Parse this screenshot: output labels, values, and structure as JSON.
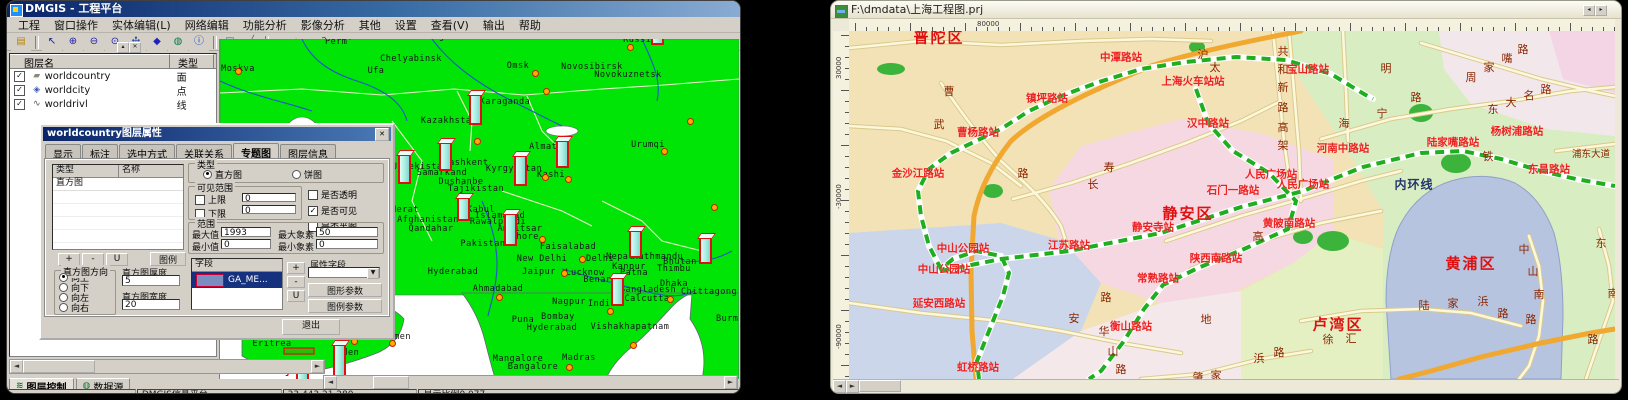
{
  "left_window": {
    "title": "DMGIS - 工程平台",
    "menu_items": [
      "工程",
      "窗口操作",
      "实体编辑(L)",
      "网络编辑",
      "功能分析",
      "影像分析",
      "其他",
      "设置",
      "查看(V)",
      "输出",
      "帮助"
    ],
    "toolbar": [
      {
        "n": "open-folder-icon",
        "g": "▤",
        "c": "#b8860b",
        "sep": false
      },
      {
        "n": "select-arrow-icon",
        "g": "↖",
        "c": "#1a1aaa",
        "sep": true
      },
      {
        "n": "zoom-in-icon",
        "g": "⊕",
        "c": "#1a1aaa",
        "sep": false
      },
      {
        "n": "zoom-out-icon",
        "g": "⊖",
        "c": "#1a1aaa",
        "sep": false
      },
      {
        "n": "zoom-free-icon",
        "g": "⊙",
        "c": "#1a1aaa",
        "sep": false
      },
      {
        "n": "pan-hand-icon",
        "g": "✣",
        "c": "#2a4a9a",
        "sep": false
      },
      {
        "n": "polygon-icon",
        "g": "◆",
        "c": "#2222bb",
        "sep": false
      },
      {
        "n": "globe-icon",
        "g": "◍",
        "c": "#0a7a4a",
        "sep": false
      },
      {
        "n": "info-icon",
        "g": "ⓘ",
        "c": "#1133bb",
        "sep": false
      },
      {
        "n": "rectangle-icon",
        "g": "▣",
        "c": "#008b8b",
        "sep": true
      },
      {
        "n": "measure-icon",
        "g": "╱",
        "c": "#666666",
        "sep": false
      },
      {
        "n": "print-icon",
        "g": "▄",
        "c": "#334466",
        "sep": true
      },
      {
        "n": "bmp-icon",
        "g": "bmp",
        "c": "#1a6a1a",
        "sep": false
      },
      {
        "n": "help-icon",
        "g": "?",
        "c": "#007700",
        "sep": false
      }
    ],
    "panel": {
      "columns": [
        "图层名",
        "类型"
      ],
      "layers": [
        {
          "name": "worldcountry",
          "type": "面",
          "icon": "▰",
          "ic": "#8a8a7a"
        },
        {
          "name": "worldcity",
          "type": "点",
          "icon": "◈",
          "ic": "#3a5aaa"
        },
        {
          "name": "worldrivl",
          "type": "线",
          "icon": "∿",
          "ic": "#555555"
        }
      ],
      "tabs": [
        {
          "label": "图层控制",
          "g": "≋"
        },
        {
          "label": "数据源",
          "g": "◍"
        }
      ]
    },
    "dialog": {
      "title": "worldcountry图层属性",
      "close_glyph": "✕",
      "tabs": [
        "显示",
        "标注",
        "选中方式",
        "关联关系",
        "专题图",
        "图层信息"
      ],
      "active_tab": "专题图",
      "list_columns": [
        "类型",
        "名称"
      ],
      "list_rows": [
        "直方图"
      ],
      "small_buttons": [
        "+",
        "-",
        "U"
      ],
      "legend_button": "图例",
      "direction_group": {
        "label": "直方图方向",
        "options": [
          "向上",
          "向下",
          "向左",
          "向右"
        ],
        "selected": "向上"
      },
      "thickness": {
        "label": "直方图厚度",
        "value": "5"
      },
      "bar_width": {
        "label": "直方图宽度",
        "value": "20"
      },
      "type_group": {
        "label": "类型",
        "options": [
          "直方图",
          "饼图"
        ],
        "selected": "直方图"
      },
      "visible_range": {
        "label": "可见范围",
        "upper": "上限",
        "upper_val": "0",
        "lower": "下限",
        "lower_val": "0"
      },
      "flags": [
        {
          "label": "是否透明",
          "checked": false
        },
        {
          "label": "是否可见",
          "checked": true
        },
        {
          "label": "是否半图",
          "checked": false
        }
      ],
      "range": {
        "label": "范围",
        "max_l": "最大值",
        "max_v": "1993",
        "maxpx_l": "最大象素",
        "maxpx_v": "50",
        "min_l": "最小值",
        "min_v": "0",
        "minpx_l": "最小象素",
        "minpx_v": "0"
      },
      "field_group": {
        "label": "字段",
        "selected": "GA_ME..."
      },
      "mini_buttons": [
        "+",
        "-",
        "U"
      ],
      "attr_label": "属性字段",
      "param_buttons": [
        "图形参数",
        "图例参数"
      ],
      "exit_button": "退出"
    },
    "status_cells": [
      "",
      "DMGIS信息平台",
      "33.443,21.280",
      "显示比例0.077"
    ],
    "map": {
      "cities": [
        {
          "t": "Perm'",
          "x": 337,
          "y": 41
        },
        {
          "t": "Yekaterinburg",
          "x": 406,
          "y": 36
        },
        {
          "t": "Chelyabinsk",
          "x": 409,
          "y": 58
        },
        {
          "t": "Ufa",
          "x": 374,
          "y": 70
        },
        {
          "t": "Moskva",
          "x": 236,
          "y": 68
        },
        {
          "t": "Omsk",
          "x": 516,
          "y": 65
        },
        {
          "t": "Novosibirsk",
          "x": 590,
          "y": 66
        },
        {
          "t": "Novokuznetsk",
          "x": 626,
          "y": 74
        },
        {
          "t": "Russia",
          "x": 638,
          "y": 39
        },
        {
          "t": "Karaganda",
          "x": 503,
          "y": 101
        },
        {
          "t": "Kazakhstan",
          "x": 447,
          "y": 120
        },
        {
          "t": "Urumqi",
          "x": 646,
          "y": 144
        },
        {
          "t": "Almaty",
          "x": 544,
          "y": 146
        },
        {
          "t": "Tashkent",
          "x": 464,
          "y": 162
        },
        {
          "t": "Samarkand",
          "x": 440,
          "y": 172
        },
        {
          "t": "Dushanbe",
          "x": 459,
          "y": 181
        },
        {
          "t": "Tajikistan",
          "x": 474,
          "y": 188
        },
        {
          "t": "Kyrgyzstan",
          "x": 512,
          "y": 168
        },
        {
          "t": "Kashi",
          "x": 549,
          "y": 174
        },
        {
          "t": "Uzbekistan",
          "x": 418,
          "y": 166
        },
        {
          "t": "Herat",
          "x": 403,
          "y": 209
        },
        {
          "t": "Afghanistan",
          "x": 426,
          "y": 219
        },
        {
          "t": "Kabul",
          "x": 479,
          "y": 209
        },
        {
          "t": "Qandahar",
          "x": 429,
          "y": 228
        },
        {
          "t": "Islamabad",
          "x": 498,
          "y": 215
        },
        {
          "t": "Rawalpindi",
          "x": 496,
          "y": 221
        },
        {
          "t": "Amritsar",
          "x": 518,
          "y": 228
        },
        {
          "t": "Lahore",
          "x": 520,
          "y": 236
        },
        {
          "t": "Pakistan",
          "x": 481,
          "y": 243
        },
        {
          "t": "Faisalabad",
          "x": 566,
          "y": 246
        },
        {
          "t": "New Delhi",
          "x": 540,
          "y": 258
        },
        {
          "t": "Delhi",
          "x": 598,
          "y": 258
        },
        {
          "t": "Jaipur",
          "x": 537,
          "y": 271
        },
        {
          "t": "Lucknow",
          "x": 583,
          "y": 272
        },
        {
          "t": "Kanpur",
          "x": 627,
          "y": 266
        },
        {
          "t": "Patna",
          "x": 632,
          "y": 272
        },
        {
          "t": "Benares",
          "x": 601,
          "y": 279
        },
        {
          "t": "Thimbu",
          "x": 672,
          "y": 268
        },
        {
          "t": "Bhutan",
          "x": 678,
          "y": 261
        },
        {
          "t": "Kathmandu",
          "x": 656,
          "y": 256
        },
        {
          "t": "Nepal",
          "x": 618,
          "y": 256
        },
        {
          "t": "Dhaka",
          "x": 672,
          "y": 283
        },
        {
          "t": "Bangladesh",
          "x": 646,
          "y": 289
        },
        {
          "t": "Chittagong",
          "x": 707,
          "y": 291
        },
        {
          "t": "Calcutta",
          "x": 645,
          "y": 298
        },
        {
          "t": "Ahmadabad",
          "x": 496,
          "y": 288
        },
        {
          "t": "Hyderabad",
          "x": 451,
          "y": 271
        },
        {
          "t": "Nagpur",
          "x": 567,
          "y": 301
        },
        {
          "t": "India",
          "x": 600,
          "y": 303
        },
        {
          "t": "Bombay",
          "x": 556,
          "y": 316
        },
        {
          "t": "Puna",
          "x": 521,
          "y": 319
        },
        {
          "t": "Hyderabad",
          "x": 550,
          "y": 327
        },
        {
          "t": "Vishakhapatnam",
          "x": 628,
          "y": 326
        },
        {
          "t": "Mangalore",
          "x": 516,
          "y": 358
        },
        {
          "t": "Madras",
          "x": 577,
          "y": 357
        },
        {
          "t": "Bangalore",
          "x": 531,
          "y": 366
        },
        {
          "t": "Burma",
          "x": 728,
          "y": 318
        },
        {
          "t": "Asmara",
          "x": 262,
          "y": 336
        },
        {
          "t": "Eritrea",
          "x": 270,
          "y": 343
        },
        {
          "t": "Sanaa",
          "x": 330,
          "y": 333
        },
        {
          "t": "Yemen",
          "x": 395,
          "y": 336
        },
        {
          "t": "Aden",
          "x": 346,
          "y": 352
        },
        {
          "t": "Djibouti",
          "x": 300,
          "y": 371,
          "cls": "red"
        }
      ],
      "bars": [
        {
          "x": 655,
          "y": 44,
          "h": 12
        },
        {
          "x": 473,
          "y": 124,
          "h": 32
        },
        {
          "x": 402,
          "y": 183,
          "h": 31
        },
        {
          "x": 443,
          "y": 170,
          "h": 30
        },
        {
          "x": 518,
          "y": 185,
          "h": 32
        },
        {
          "x": 560,
          "y": 167,
          "h": 29
        },
        {
          "x": 461,
          "y": 220,
          "h": 25
        },
        {
          "x": 508,
          "y": 245,
          "h": 34
        },
        {
          "x": 633,
          "y": 257,
          "h": 29
        },
        {
          "x": 703,
          "y": 263,
          "h": 28
        },
        {
          "x": 615,
          "y": 305,
          "h": 30
        },
        {
          "x": 337,
          "y": 378,
          "h": 36
        },
        {
          "x": 300,
          "y": 384,
          "h": 20
        }
      ],
      "dots": [
        [
          236,
          70
        ],
        [
          533,
          72
        ],
        [
          628,
          46
        ],
        [
          544,
          90
        ],
        [
          566,
          178
        ],
        [
          543,
          176
        ],
        [
          475,
          140
        ],
        [
          540,
          238
        ],
        [
          580,
          258
        ],
        [
          562,
          272
        ],
        [
          497,
          296
        ],
        [
          608,
          310
        ],
        [
          668,
          298
        ],
        [
          631,
          344
        ],
        [
          567,
          366
        ],
        [
          712,
          206
        ],
        [
          662,
          150
        ],
        [
          688,
          120
        ],
        [
          352,
          340
        ],
        [
          390,
          342
        ]
      ]
    }
  },
  "right_window": {
    "title": "F:\\dmdata\\上海工程图.prj",
    "title_buttons": [
      "◂",
      "▸"
    ],
    "ruler": {
      "h_label": "80000",
      "v_labels": [
        {
          "t": "30000",
          "y": 70
        },
        {
          "t": "-30000",
          "y": 200
        },
        {
          "t": "-90000",
          "y": 340
        }
      ]
    },
    "map": {
      "districts": [
        {
          "t": "普陀区",
          "x": 938,
          "y": 36
        },
        {
          "t": "静安区",
          "x": 1187,
          "y": 212
        },
        {
          "t": "黄浦区",
          "x": 1470,
          "y": 262
        },
        {
          "t": "卢湾区",
          "x": 1337,
          "y": 323
        }
      ],
      "stations": [
        {
          "t": "中潭路站",
          "x": 1120,
          "y": 56
        },
        {
          "t": "镇坪路站",
          "x": 1046,
          "y": 97
        },
        {
          "t": "曹杨路站",
          "x": 977,
          "y": 131
        },
        {
          "t": "上海火车站站",
          "x": 1192,
          "y": 80
        },
        {
          "t": "汉中路站",
          "x": 1207,
          "y": 122
        },
        {
          "t": "宝山路站",
          "x": 1307,
          "y": 68
        },
        {
          "t": "金沙江路站",
          "x": 917,
          "y": 172
        },
        {
          "t": "中山公园站",
          "x": 962,
          "y": 247
        },
        {
          "t": "中山公园站",
          "x": 943,
          "y": 268
        },
        {
          "t": "江苏路站",
          "x": 1068,
          "y": 244
        },
        {
          "t": "静安寺站",
          "x": 1152,
          "y": 226
        },
        {
          "t": "石门一路站",
          "x": 1232,
          "y": 189
        },
        {
          "t": "人民广场站",
          "x": 1270,
          "y": 173
        },
        {
          "t": "人民广场站",
          "x": 1302,
          "y": 183
        },
        {
          "t": "河南中路站",
          "x": 1342,
          "y": 147
        },
        {
          "t": "黄陂南路站",
          "x": 1288,
          "y": 222
        },
        {
          "t": "陕西南路站",
          "x": 1215,
          "y": 257
        },
        {
          "t": "常熟路站",
          "x": 1157,
          "y": 277
        },
        {
          "t": "衡山路站",
          "x": 1130,
          "y": 325
        },
        {
          "t": "延安西路站",
          "x": 938,
          "y": 302
        },
        {
          "t": "虹桥路站",
          "x": 977,
          "y": 366
        },
        {
          "t": "陆家嘴路站",
          "x": 1452,
          "y": 141
        },
        {
          "t": "东昌路站",
          "x": 1548,
          "y": 168
        },
        {
          "t": "杨树浦路站",
          "x": 1516,
          "y": 130
        }
      ],
      "road_chars": [
        {
          "t": "共",
          "x": 1282,
          "y": 50
        },
        {
          "t": "和",
          "x": 1282,
          "y": 68
        },
        {
          "t": "新",
          "x": 1282,
          "y": 86
        },
        {
          "t": "路",
          "x": 1282,
          "y": 106
        },
        {
          "t": "高",
          "x": 1282,
          "y": 126
        },
        {
          "t": "架",
          "x": 1282,
          "y": 144
        },
        {
          "t": "周",
          "x": 1470,
          "y": 76
        },
        {
          "t": "家",
          "x": 1488,
          "y": 66
        },
        {
          "t": "嘴",
          "x": 1506,
          "y": 57
        },
        {
          "t": "路",
          "x": 1522,
          "y": 48
        },
        {
          "t": "海",
          "x": 1343,
          "y": 122
        },
        {
          "t": "宁",
          "x": 1381,
          "y": 112
        },
        {
          "t": "路",
          "x": 1415,
          "y": 96
        },
        {
          "t": "东",
          "x": 1492,
          "y": 108
        },
        {
          "t": "大",
          "x": 1510,
          "y": 101
        },
        {
          "t": "名",
          "x": 1528,
          "y": 94
        },
        {
          "t": "路",
          "x": 1545,
          "y": 88
        },
        {
          "t": "长",
          "x": 1092,
          "y": 183
        },
        {
          "t": "寿",
          "x": 1108,
          "y": 166
        },
        {
          "t": "路",
          "x": 1022,
          "y": 172
        },
        {
          "t": "曹",
          "x": 948,
          "y": 90
        },
        {
          "t": "武",
          "x": 938,
          "y": 123
        },
        {
          "t": "明",
          "x": 1385,
          "y": 67
        },
        {
          "t": "沪",
          "x": 1202,
          "y": 53
        },
        {
          "t": "太",
          "x": 1214,
          "y": 66
        },
        {
          "t": "安",
          "x": 1073,
          "y": 317
        },
        {
          "t": "路",
          "x": 1105,
          "y": 296
        },
        {
          "t": "华",
          "x": 1103,
          "y": 330
        },
        {
          "t": "山",
          "x": 1112,
          "y": 350
        },
        {
          "t": "路",
          "x": 1120,
          "y": 368
        },
        {
          "t": "肇",
          "x": 1197,
          "y": 376
        },
        {
          "t": "家",
          "x": 1215,
          "y": 374
        },
        {
          "t": "浜",
          "x": 1258,
          "y": 357
        },
        {
          "t": "路",
          "x": 1278,
          "y": 351
        },
        {
          "t": "中",
          "x": 1523,
          "y": 248
        },
        {
          "t": "山",
          "x": 1532,
          "y": 270
        },
        {
          "t": "南",
          "x": 1538,
          "y": 293
        },
        {
          "t": "路",
          "x": 1530,
          "y": 318
        },
        {
          "t": "东",
          "x": 1600,
          "y": 242
        },
        {
          "t": "南",
          "x": 1612,
          "y": 292
        },
        {
          "t": "路",
          "x": 1592,
          "y": 338
        },
        {
          "t": "陆",
          "x": 1423,
          "y": 304
        },
        {
          "t": "家",
          "x": 1452,
          "y": 302
        },
        {
          "t": "浜",
          "x": 1482,
          "y": 300
        },
        {
          "t": "路",
          "x": 1502,
          "y": 312
        },
        {
          "t": "徐",
          "x": 1327,
          "y": 338
        },
        {
          "t": "汇",
          "x": 1350,
          "y": 337
        },
        {
          "t": "地",
          "x": 1205,
          "y": 318
        },
        {
          "t": "铁",
          "x": 1487,
          "y": 155
        },
        {
          "t": "高",
          "x": 1257,
          "y": 235
        }
      ],
      "navy_labels": [
        {
          "t": "内环线",
          "x": 1413,
          "y": 183
        }
      ],
      "small_labels": [
        {
          "t": "浦东大道",
          "x": 1590,
          "y": 152
        }
      ]
    }
  }
}
